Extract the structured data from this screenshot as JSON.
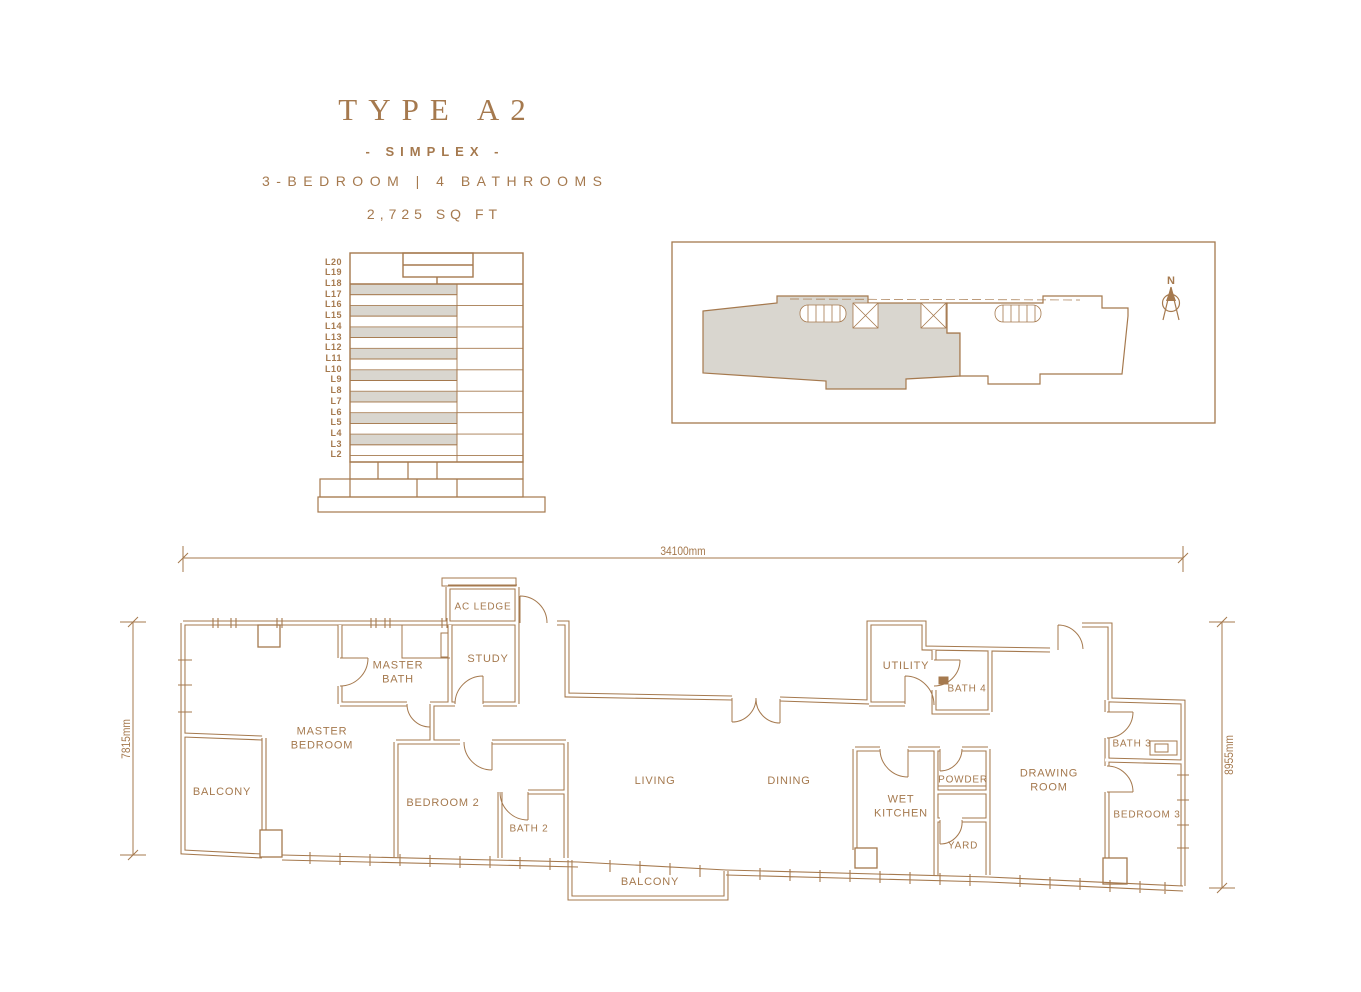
{
  "header": {
    "title": "TYPE A2",
    "subtitle": "- SIMPLEX -",
    "spec": "3-BEDROOM | 4 BATHROOMS",
    "area": "2,725 SQ FT"
  },
  "elevation": {
    "levels": [
      "L20",
      "L19",
      "L18",
      "L17",
      "L16",
      "L15",
      "L14",
      "L13",
      "L12",
      "L11",
      "L10",
      "L9",
      "L8",
      "L7",
      "L6",
      "L5",
      "L4",
      "L3",
      "L2"
    ]
  },
  "key_plan": {
    "north_label": "N"
  },
  "floor_plan": {
    "dimensions": {
      "top": "34100mm",
      "left": "7815mm",
      "right": "8955mm"
    },
    "rooms": {
      "ac_ledge": "AC LEDGE",
      "study": "STUDY",
      "master_bath": "MASTER BATH",
      "utility": "UTILITY",
      "bath_4": "BATH 4",
      "master_bedroom": "MASTER BEDROOM",
      "bath_3": "BATH 3",
      "balcony_left": "BALCONY",
      "living": "LIVING",
      "dining": "DINING",
      "powder": "POWDER",
      "drawing_room": "DRAWING ROOM",
      "bedroom_2": "BEDROOM 2",
      "wet_kitchen": "WET KITCHEN",
      "bath_2": "BATH 2",
      "bedroom_3": "BEDROOM 3",
      "yard": "YARD",
      "balcony_bottom": "BALCONY"
    }
  },
  "colors": {
    "line": "#A5794E",
    "shade": "#D9D6CF"
  }
}
